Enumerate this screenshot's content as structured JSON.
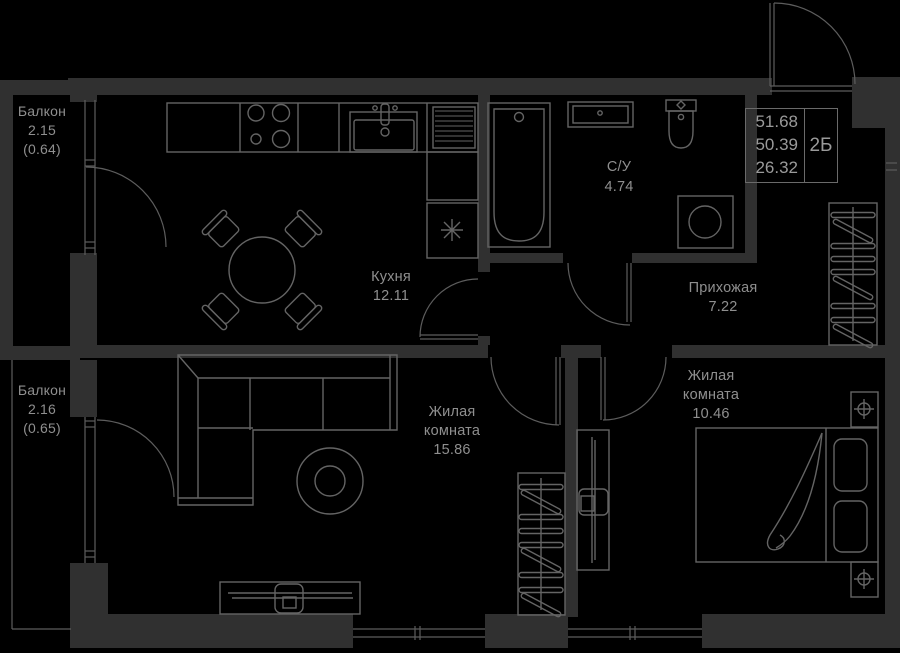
{
  "colors": {
    "background": "#000000",
    "wall_fill": "#303030",
    "thin_line": "#5d5d5d",
    "furniture_line": "#646464",
    "label_text": "#8f8f8f",
    "info_text": "#9a9a9a"
  },
  "info_box": {
    "area_total": "51.68",
    "area_no_balcony": "50.39",
    "area_living": "26.32",
    "unit_type": "2Б"
  },
  "rooms": {
    "balcony1": {
      "name": "Балкон",
      "area": "2.15",
      "coefficient": "(0.64)"
    },
    "balcony2": {
      "name": "Балкон",
      "area": "2.16",
      "coefficient": "(0.65)"
    },
    "kitchen": {
      "name": "Кухня",
      "area": "12.11"
    },
    "bathroom": {
      "name": "С/У",
      "area": "4.74"
    },
    "hallway": {
      "name": "Прихожая",
      "area": "7.22"
    },
    "living_room": {
      "name_line1": "Жилая",
      "name_line2": "комната",
      "area": "15.86"
    },
    "bedroom": {
      "name_line1": "Жилая",
      "name_line2": "комната",
      "area": "10.46"
    }
  },
  "fixtures": [
    "stove-icon",
    "kitchen-sink-icon",
    "fridge-icon",
    "dining-table-icon",
    "bathtub-icon",
    "vanity-sink-icon",
    "toilet-icon",
    "washing-machine-icon",
    "wardrobe-icon",
    "sofa-icon",
    "pouf-icon",
    "tv-stand-icon",
    "tv-icon",
    "bed-icon",
    "nightstand-lamp-icon",
    "door-swing-icon",
    "window-icon"
  ]
}
